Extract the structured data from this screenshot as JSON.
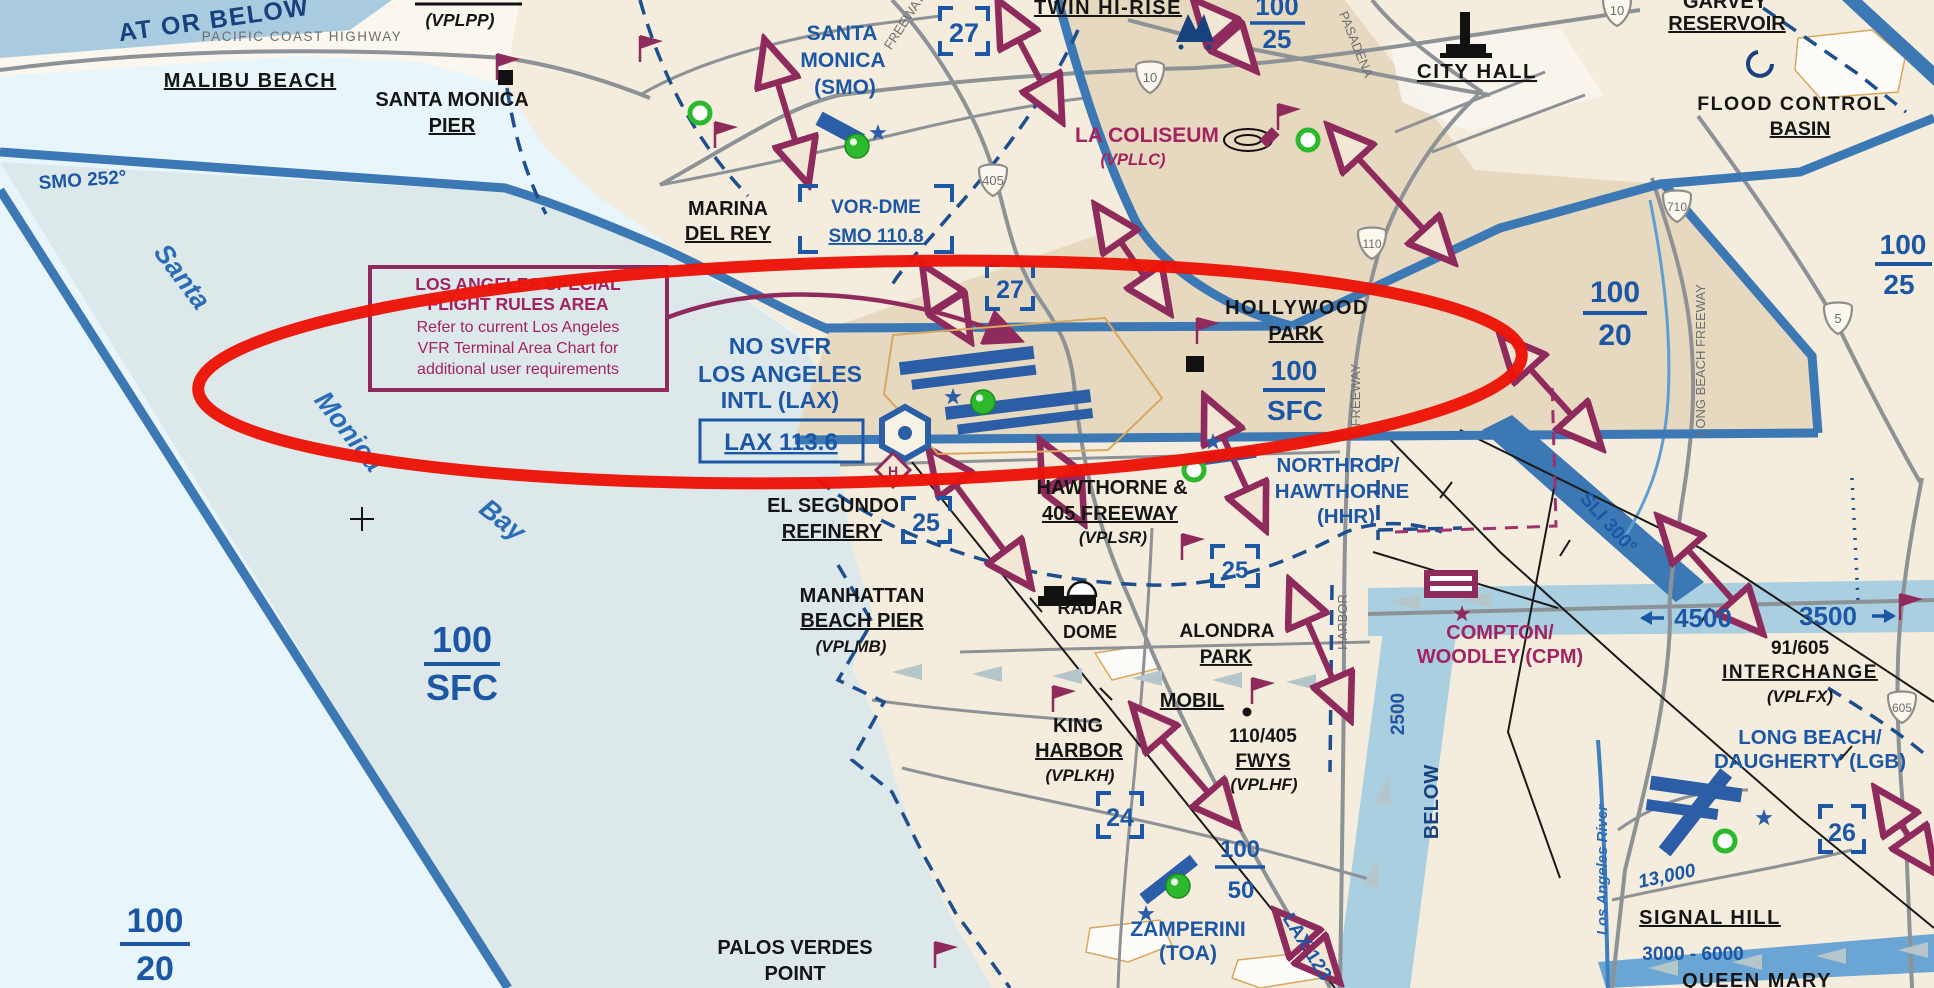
{
  "map": {
    "region": "Los Angeles basin",
    "chart_type": "VFR sectional excerpt, LAX Special Flight Rules Area circled in red"
  },
  "colors": {
    "annotation_red": "#ec1408",
    "boundary_blue": "#3b78b4",
    "chart_blue": "#1c57a5",
    "magenta": "#a32361",
    "maroon_arrow": "#8f2a5c",
    "land_light": "#f4ecdc",
    "land_urban": "#e7d8c0",
    "sea_outer": "#e8f5fa",
    "sea_sfra": "#dde8ea",
    "checkpoint_green": "#2db92d"
  },
  "sfra_note": {
    "title1": "LOS ANGELES SPECIAL",
    "title2": "FLIGHT RULES AREA",
    "body1": "Refer to current Los Angeles",
    "body2": "VFR Terminal Area Chart for",
    "body3": "additional user requirements"
  },
  "lax": {
    "no_svfr": "NO SVFR",
    "name1": "LOS ANGELES",
    "name2": "INTL (LAX)",
    "freq": "LAX  113.6",
    "radial": "LAX 123",
    "helipad": "H"
  },
  "smo": {
    "n1": "SANTA",
    "n2": "MONICA",
    "n3": "(SMO)",
    "vor1": "VOR-DME",
    "vor2": "SMO 110.8",
    "radial": "SMO 252°"
  },
  "hhr": {
    "n1": "NORTHROP/",
    "n2": "HAWTHORNE",
    "n3": "(HHR)"
  },
  "toa": {
    "n1": "ZAMPERINI",
    "n2": "(TOA)"
  },
  "cpm": {
    "n1": "COMPTON/",
    "n2": "WOODLEY (CPM)"
  },
  "lgb": {
    "n1": "LONG BEACH/",
    "n2": "DAUGHERTY (LGB)"
  },
  "sli": {
    "radial": "SLI 300°"
  },
  "checkpoints": {
    "vplpp": "(VPLPP)",
    "malibu": "MALIBU BEACH",
    "smo_pier1": "SANTA MONICA",
    "smo_pier2": "PIER",
    "marina1": "MARINA",
    "marina2": "DEL REY",
    "twin": "TWIN HI-RISE",
    "coliseum1": "LA COLISEUM",
    "coliseum2": "(VPLLC)",
    "city_hall": "CITY HALL",
    "garvey1": "GARVEY",
    "garvey2": "RESERVOIR",
    "flood1": "FLOOD CONTROL",
    "flood2": "BASIN",
    "hollywood1": "HOLLYWOOD",
    "hollywood2": "PARK",
    "segundo1": "EL SEGUNDO",
    "segundo2": "REFINERY",
    "manhattan1": "MANHATTAN",
    "manhattan2": "BEACH PIER",
    "manhattan3": "(VPLMB)",
    "haw405_1": "HAWTHORNE &",
    "haw405_2": "405 FREEWAY",
    "haw405_3": "(VPLSR)",
    "radar1": "RADAR",
    "radar2": "DOME",
    "alondra1": "ALONDRA",
    "alondra2": "PARK",
    "mobil": "MOBIL",
    "king1": "KING",
    "king2": "HARBOR",
    "king3": "(VPLKH)",
    "fwys1": "110/405",
    "fwys2": "FWYS",
    "fwys3": "(VPLHF)",
    "intx1": "91/605",
    "intx2": "INTERCHANGE",
    "intx3": "(VPLFX)",
    "signal": "SIGNAL HILL",
    "queen": "QUEEN MARY",
    "palos1": "PALOS VERDES",
    "palos2": "POINT"
  },
  "altitudes": {
    "band": "AT OR BELOW",
    "f_hollywood": {
      "n": "100",
      "d": "SFC"
    },
    "f_bay": {
      "n": "100",
      "d": "SFC"
    },
    "f_sw": {
      "n": "100",
      "d": "20"
    },
    "f_ne": {
      "n": "100",
      "d": "20"
    },
    "f_twin": {
      "n": "100",
      "d": "25"
    },
    "f_east": {
      "n": "100",
      "d": "25"
    },
    "f_toa": {
      "n": "100",
      "d": "50"
    },
    "c4500": "4500",
    "c3500": "3500",
    "v2500": "2500",
    "below": "BELOW",
    "lgb_high": "13,000",
    "lgb_range": "3000 - 6000"
  },
  "geo": {
    "bay1": "Santa",
    "bay2": "Monica",
    "bay3": "Bay",
    "river": "Los Angeles River",
    "pch": "PACIFIC COAST HIGHWAY"
  },
  "hwy": {
    "pasadena": "PASADENA",
    "fwy": "FREEWAY",
    "harbor": "HARBOR",
    "longbeach": "LONG  BEACH  FREEWAY",
    "s405": "405",
    "s10": "10",
    "s110": "110",
    "s710": "710",
    "s5": "5",
    "s605": "605"
  },
  "grid": {
    "g27": "27",
    "g25": "25",
    "g24": "24",
    "g26": "26"
  }
}
